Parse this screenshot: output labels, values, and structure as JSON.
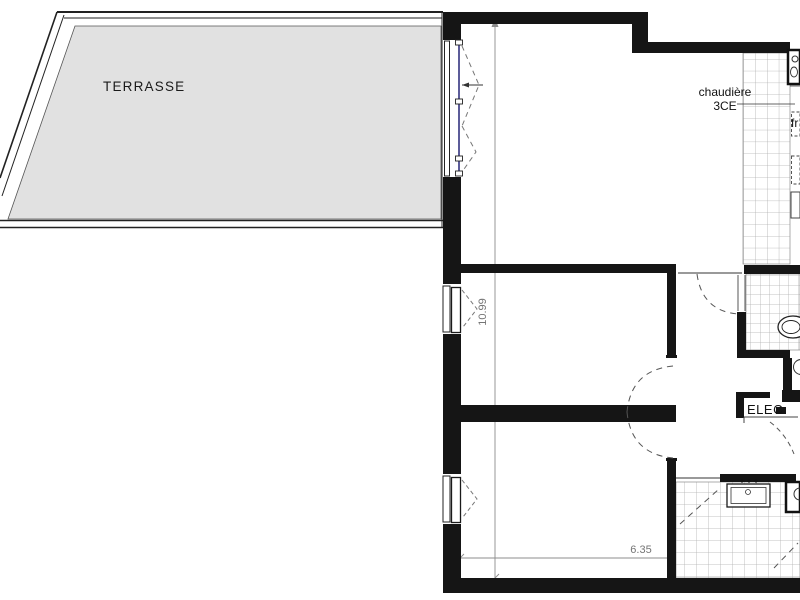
{
  "plan": {
    "type": "architectural-floor-plan",
    "labels": {
      "terrace": "TERRASSE",
      "boiler_line1": "chaudière",
      "boiler_line2": "3CE",
      "fridge_abbrev": "fr",
      "electrical_closet": "ELEC"
    },
    "dimensions": {
      "vertical_m": "10.99",
      "horizontal_m": "6.35"
    },
    "colors": {
      "wall": "#151515",
      "terrace_fill": "#e1e1e1",
      "tile_line": "#b0b0b0",
      "dimension": "#7a7a7a",
      "window_mullion": "#5c5c99",
      "background": "#ffffff"
    },
    "fixtures": [
      "tall-window",
      "bedroom1-window",
      "bedroom2-window",
      "kitchen-sink",
      "fridge",
      "toilet",
      "bathroom-vanity",
      "shower-column",
      "washing-machine"
    ]
  }
}
